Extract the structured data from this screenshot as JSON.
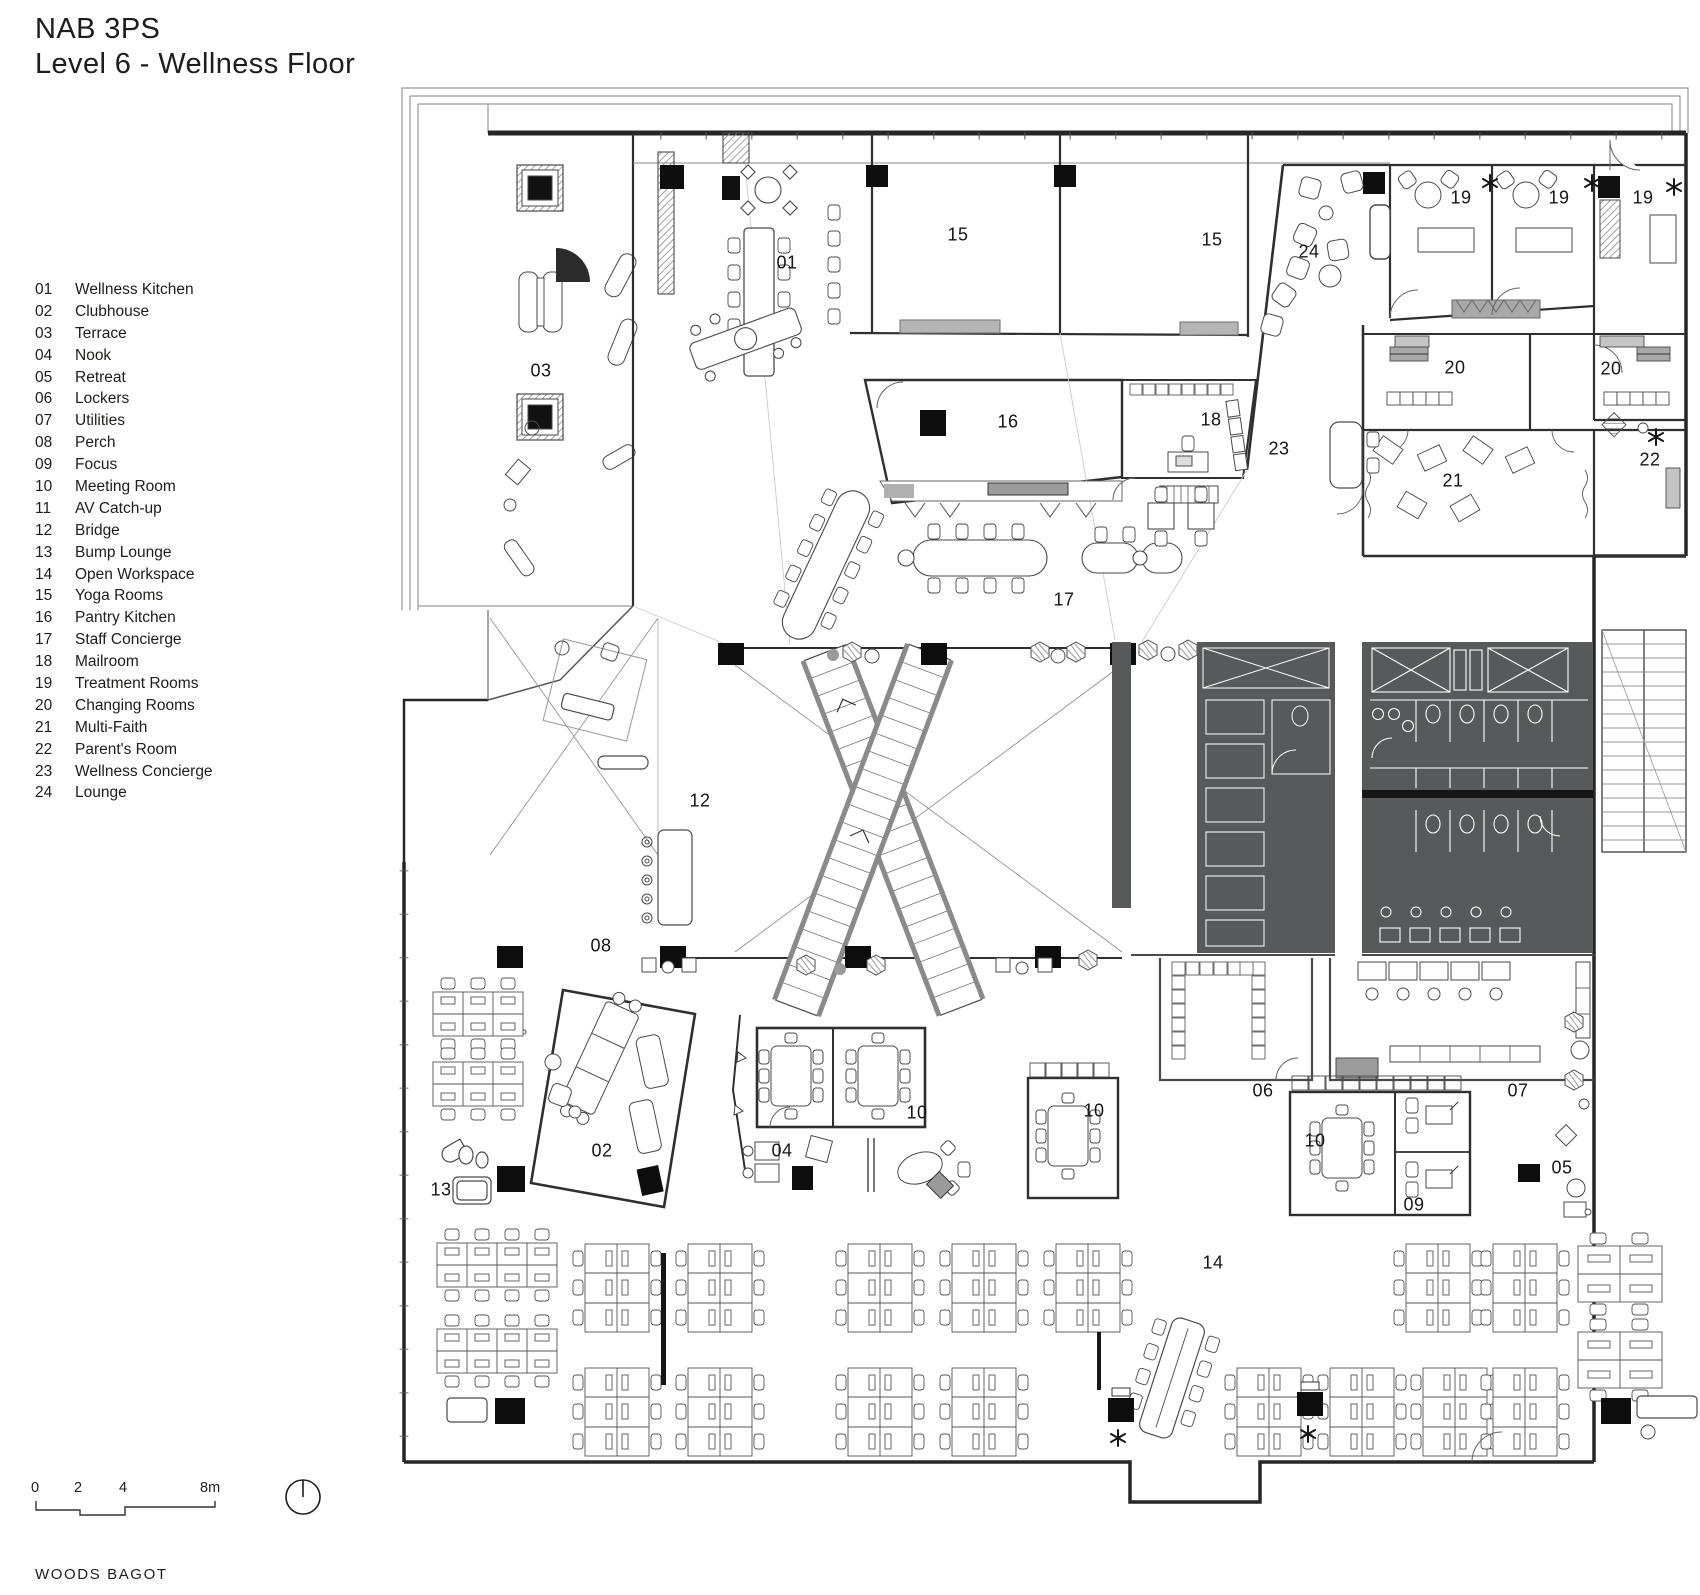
{
  "title": {
    "line1": "NAB 3PS",
    "line2": "Level 6 - Wellness Floor"
  },
  "legend": [
    {
      "num": "01",
      "label": "Wellness Kitchen"
    },
    {
      "num": "02",
      "label": "Clubhouse"
    },
    {
      "num": "03",
      "label": "Terrace"
    },
    {
      "num": "04",
      "label": "Nook"
    },
    {
      "num": "05",
      "label": "Retreat"
    },
    {
      "num": "06",
      "label": "Lockers"
    },
    {
      "num": "07",
      "label": "Utilities"
    },
    {
      "num": "08",
      "label": "Perch"
    },
    {
      "num": "09",
      "label": "Focus"
    },
    {
      "num": "10",
      "label": "Meeting Room"
    },
    {
      "num": "11",
      "label": "AV Catch-up"
    },
    {
      "num": "12",
      "label": "Bridge"
    },
    {
      "num": "13",
      "label": "Bump Lounge"
    },
    {
      "num": "14",
      "label": "Open Workspace"
    },
    {
      "num": "15",
      "label": "Yoga Rooms"
    },
    {
      "num": "16",
      "label": "Pantry Kitchen"
    },
    {
      "num": "17",
      "label": "Staff Concierge"
    },
    {
      "num": "18",
      "label": "Mailroom"
    },
    {
      "num": "19",
      "label": "Treatment Rooms"
    },
    {
      "num": "20",
      "label": "Changing Rooms"
    },
    {
      "num": "21",
      "label": "Multi-Faith"
    },
    {
      "num": "22",
      "label": "Parent's Room"
    },
    {
      "num": "23",
      "label": "Wellness Concierge"
    },
    {
      "num": "24",
      "label": "Lounge"
    }
  ],
  "plan_labels": [
    {
      "t": "01",
      "x": 787,
      "y": 263
    },
    {
      "t": "03",
      "x": 541,
      "y": 371
    },
    {
      "t": "15",
      "x": 958,
      "y": 235
    },
    {
      "t": "15",
      "x": 1212,
      "y": 240
    },
    {
      "t": "24",
      "x": 1309,
      "y": 252
    },
    {
      "t": "19",
      "x": 1461,
      "y": 198
    },
    {
      "t": "19",
      "x": 1559,
      "y": 198
    },
    {
      "t": "19",
      "x": 1643,
      "y": 198
    },
    {
      "t": "20",
      "x": 1455,
      "y": 368
    },
    {
      "t": "20",
      "x": 1611,
      "y": 369
    },
    {
      "t": "16",
      "x": 1008,
      "y": 422
    },
    {
      "t": "18",
      "x": 1211,
      "y": 420
    },
    {
      "t": "23",
      "x": 1279,
      "y": 449
    },
    {
      "t": "21",
      "x": 1453,
      "y": 481
    },
    {
      "t": "22",
      "x": 1650,
      "y": 460
    },
    {
      "t": "17",
      "x": 1064,
      "y": 600
    },
    {
      "t": "12",
      "x": 700,
      "y": 801
    },
    {
      "t": "08",
      "x": 601,
      "y": 946
    },
    {
      "t": "02",
      "x": 602,
      "y": 1151
    },
    {
      "t": "13",
      "x": 441,
      "y": 1190
    },
    {
      "t": "04",
      "x": 782,
      "y": 1151
    },
    {
      "t": "10",
      "x": 917,
      "y": 1113
    },
    {
      "t": "10",
      "x": 1094,
      "y": 1111
    },
    {
      "t": "10",
      "x": 1315,
      "y": 1141
    },
    {
      "t": "06",
      "x": 1263,
      "y": 1091
    },
    {
      "t": "07",
      "x": 1518,
      "y": 1091
    },
    {
      "t": "09",
      "x": 1414,
      "y": 1205
    },
    {
      "t": "05",
      "x": 1562,
      "y": 1168
    },
    {
      "t": "14",
      "x": 1213,
      "y": 1263
    }
  ],
  "scale": {
    "t0": "0",
    "t1": "2",
    "t2": "4",
    "t3": "8m"
  },
  "footer": {
    "firm": "WOODS BAGOT"
  },
  "colors": {
    "ink": "#2a2a2a",
    "core_fill": "#58595b",
    "light_line": "#9a9a9a"
  }
}
